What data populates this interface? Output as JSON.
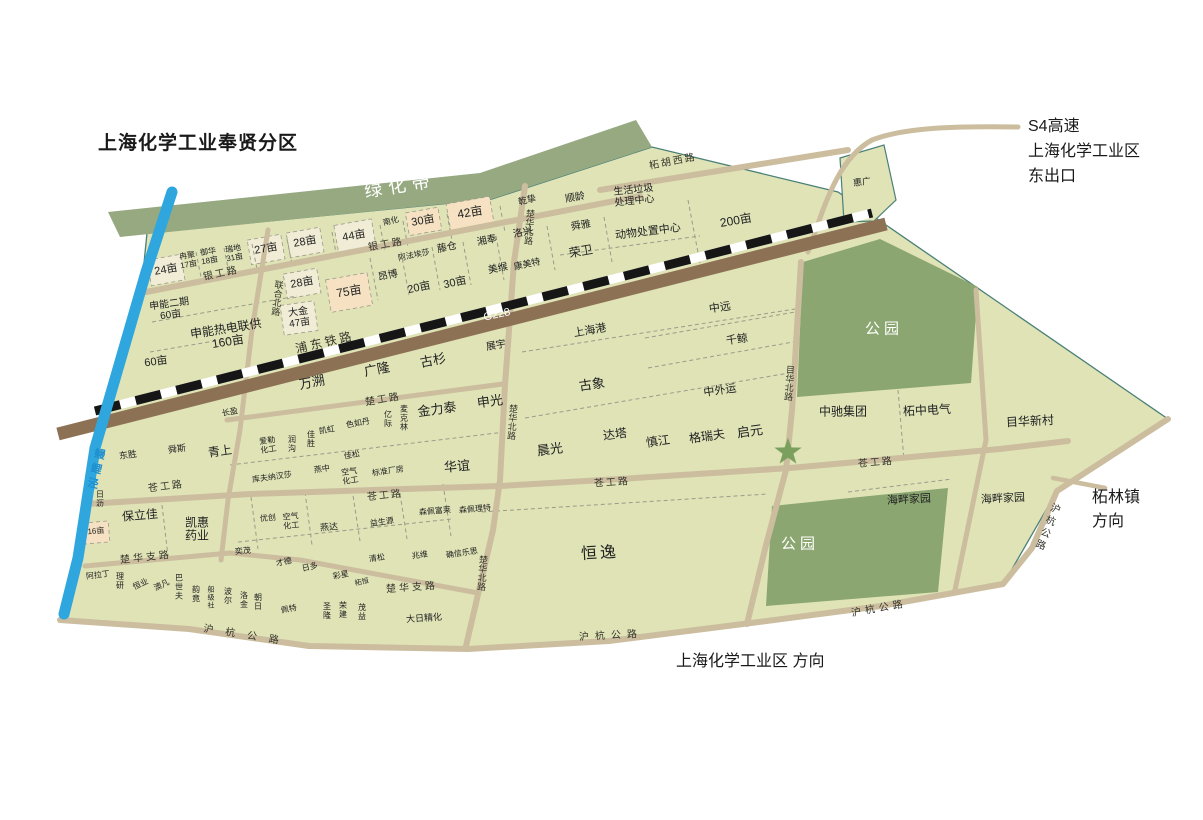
{
  "title": "上海化学工业奉贤分区",
  "annotations": {
    "s4_exit_text": "S4高速\n上海化学工业区\n东出口",
    "zhelin_text": "柘林镇\n方向",
    "direction_text": "上海化学工业区  方向"
  },
  "colors": {
    "map_body": "#dfe3b6",
    "green_band": "#97a981",
    "park": "#8ba671",
    "road": "#cbbd9e",
    "railway": "#8d7154",
    "river": "#2fa7de",
    "dashed_line": "#161616",
    "cream_parcel": "#f1ecd6",
    "peach_parcel": "#f6e2c2",
    "star": "#7ba05e",
    "boundary": "#4a8078",
    "river_label": "#1d8fd0"
  },
  "map_labels": [
    {
      "n": "green-belt-label",
      "t": "绿化带",
      "x": 400,
      "y": 186,
      "fs": 18,
      "r": -9,
      "ls": 6,
      "c": "wh"
    },
    {
      "n": "parcel-24mu",
      "t": "24亩",
      "x": 166,
      "y": 270,
      "fs": 11,
      "r": -10
    },
    {
      "n": "parcel-ranju-17mu",
      "t": "冉聚\n17亩",
      "x": 188,
      "y": 261,
      "fs": 8,
      "r": -10
    },
    {
      "n": "parcel-yuhua-18mu",
      "t": "御华\n18亩",
      "x": 209,
      "y": 257,
      "fs": 8,
      "r": -10
    },
    {
      "n": "parcel-ruidi-31mu",
      "t": "瑞地\n31亩",
      "x": 234,
      "y": 254,
      "fs": 8,
      "r": -10
    },
    {
      "n": "parcel-27mu",
      "t": "27亩",
      "x": 266,
      "y": 249,
      "fs": 11,
      "r": -10
    },
    {
      "n": "parcel-28mu-a",
      "t": "28亩",
      "x": 305,
      "y": 242,
      "fs": 11,
      "r": -10
    },
    {
      "n": "parcel-44mu",
      "t": "44亩",
      "x": 354,
      "y": 236,
      "fs": 11,
      "r": -10
    },
    {
      "n": "parcel-nanhua",
      "t": "南化",
      "x": 391,
      "y": 222,
      "fs": 8,
      "r": -14
    },
    {
      "n": "parcel-30mu-a",
      "t": "30亩",
      "x": 423,
      "y": 221,
      "fs": 11,
      "r": -10
    },
    {
      "n": "parcel-42mu",
      "t": "42亩",
      "x": 470,
      "y": 213,
      "fs": 12,
      "r": -10
    },
    {
      "n": "parcel-qianzhi",
      "t": "乾挚",
      "x": 527,
      "y": 200,
      "fs": 9,
      "r": -14
    },
    {
      "n": "parcel-shunling",
      "t": "顺龄",
      "x": 575,
      "y": 198,
      "fs": 10,
      "r": -10
    },
    {
      "n": "facility-waste-center",
      "t": "生活垃圾\n处理中心",
      "x": 634,
      "y": 196,
      "fs": 10,
      "r": -6
    },
    {
      "n": "road-zhehuxi",
      "t": "柘胡西路",
      "x": 673,
      "y": 162,
      "fs": 10,
      "r": -11,
      "ls": 2,
      "c": "road"
    },
    {
      "n": "parcel-huiguang",
      "t": "惠广",
      "x": 862,
      "y": 182,
      "fs": 9,
      "r": -8
    },
    {
      "n": "road-yingong-a",
      "t": "银工路",
      "x": 221,
      "y": 274,
      "fs": 10,
      "r": -12,
      "ls": 2,
      "c": "road"
    },
    {
      "n": "road-yingong-b",
      "t": "银工路",
      "x": 386,
      "y": 245,
      "fs": 10,
      "r": -10,
      "ls": 2,
      "c": "road"
    },
    {
      "n": "road-chuhuabei-n",
      "t": "楚华北路",
      "x": 529,
      "y": 227,
      "fs": 9,
      "r": 4,
      "c": "vt road"
    },
    {
      "n": "parcel-shunya",
      "t": "舜雅",
      "x": 581,
      "y": 226,
      "fs": 10,
      "r": -10
    },
    {
      "n": "parcel-luoxing",
      "t": "洛兴",
      "x": 523,
      "y": 233,
      "fs": 10,
      "r": -12
    },
    {
      "n": "parcel-xiangfeng",
      "t": "湘奉",
      "x": 487,
      "y": 241,
      "fs": 10,
      "r": -12
    },
    {
      "n": "parcel-tengcang",
      "t": "藤仓",
      "x": 447,
      "y": 248,
      "fs": 10,
      "r": -12
    },
    {
      "n": "parcel-afaaisha",
      "t": "阿法埃莎",
      "x": 414,
      "y": 256,
      "fs": 8,
      "r": -12
    },
    {
      "n": "parcel-angbo",
      "t": "昂博",
      "x": 388,
      "y": 276,
      "fs": 10,
      "r": -12
    },
    {
      "n": "parcel-meigou",
      "t": "美缑",
      "x": 498,
      "y": 269,
      "fs": 10,
      "r": -12
    },
    {
      "n": "parcel-kangmeite",
      "t": "康美特",
      "x": 527,
      "y": 264,
      "fs": 9,
      "r": -12
    },
    {
      "n": "parcel-rongwei",
      "t": "荣卫",
      "x": 581,
      "y": 252,
      "fs": 12,
      "r": -10
    },
    {
      "n": "facility-animal-center",
      "t": "动物处置中心",
      "x": 648,
      "y": 232,
      "fs": 11,
      "r": -7
    },
    {
      "n": "parcel-200mu",
      "t": "200亩",
      "x": 736,
      "y": 221,
      "fs": 12,
      "r": -10
    },
    {
      "n": "parcel-20mu",
      "t": "20亩",
      "x": 419,
      "y": 288,
      "fs": 11,
      "r": -12
    },
    {
      "n": "parcel-30mu-b",
      "t": "30亩",
      "x": 455,
      "y": 283,
      "fs": 11,
      "r": -12
    },
    {
      "n": "parcel-28mu-b",
      "t": "28亩",
      "x": 302,
      "y": 283,
      "fs": 11,
      "r": -10
    },
    {
      "n": "parcel-75mu",
      "t": "75亩",
      "x": 349,
      "y": 292,
      "fs": 12,
      "r": -10
    },
    {
      "n": "parcel-dajin-47mu",
      "t": "大金\n47亩",
      "x": 299,
      "y": 318,
      "fs": 10,
      "r": -8
    },
    {
      "n": "road-lianhebei",
      "t": "联合北路",
      "x": 277,
      "y": 298,
      "fs": 9,
      "r": 7,
      "c": "vt road"
    },
    {
      "n": "parcel-shenneng2-60mu",
      "t": "申能二期\n60亩",
      "x": 170,
      "y": 310,
      "fs": 10,
      "r": -8
    },
    {
      "n": "parcel-shenneng-160mu",
      "t": "申能热电联供\n160亩",
      "x": 227,
      "y": 336,
      "fs": 12,
      "r": -9
    },
    {
      "n": "parcel-60mu",
      "t": "60亩",
      "x": 156,
      "y": 362,
      "fs": 11,
      "r": -8
    },
    {
      "n": "railway-pudong-label",
      "t": "浦东铁路",
      "x": 325,
      "y": 343,
      "fs": 12,
      "r": -13,
      "ls": 3,
      "c": "road"
    },
    {
      "n": "route-g228-label",
      "t": "G228",
      "x": 497,
      "y": 315,
      "fs": 11,
      "r": -12,
      "c": "wh"
    },
    {
      "n": "parcel-wansu",
      "t": "万溯",
      "x": 312,
      "y": 383,
      "fs": 13,
      "r": -11
    },
    {
      "n": "parcel-guanglong",
      "t": "广隆",
      "x": 377,
      "y": 370,
      "fs": 13,
      "r": -11
    },
    {
      "n": "parcel-gushan",
      "t": "古杉",
      "x": 433,
      "y": 361,
      "fs": 13,
      "r": -11
    },
    {
      "n": "parcel-zhanyu",
      "t": "展宇",
      "x": 496,
      "y": 346,
      "fs": 10,
      "r": -10
    },
    {
      "n": "road-chugong",
      "t": "楚工路",
      "x": 383,
      "y": 400,
      "fs": 10,
      "r": -10,
      "ls": 2,
      "c": "road"
    },
    {
      "n": "parcel-serudan",
      "t": "色如丹",
      "x": 358,
      "y": 424,
      "fs": 8,
      "r": -10
    },
    {
      "n": "parcel-yiji",
      "t": "亿\n际",
      "x": 388,
      "y": 420,
      "fs": 8
    },
    {
      "n": "parcel-maikelin",
      "t": "麦\n克\n林",
      "x": 404,
      "y": 419,
      "fs": 8
    },
    {
      "n": "parcel-jinlitai",
      "t": "金力泰",
      "x": 437,
      "y": 410,
      "fs": 13,
      "r": -8
    },
    {
      "n": "parcel-shenguang",
      "t": "申光",
      "x": 490,
      "y": 402,
      "fs": 13,
      "r": -8
    },
    {
      "n": "road-chuhuabei-m",
      "t": "楚华北路",
      "x": 512,
      "y": 422,
      "fs": 9,
      "r": 4,
      "c": "vt road"
    },
    {
      "n": "parcel-guxiang",
      "t": "古象",
      "x": 592,
      "y": 385,
      "fs": 13,
      "r": -8
    },
    {
      "n": "parcel-shanghaigang",
      "t": "上海港",
      "x": 590,
      "y": 331,
      "fs": 11,
      "r": -10
    },
    {
      "n": "parcel-zhongyuan",
      "t": "中远",
      "x": 720,
      "y": 308,
      "fs": 11,
      "r": -8
    },
    {
      "n": "parcel-qianjing",
      "t": "千鲸",
      "x": 737,
      "y": 340,
      "fs": 11,
      "r": -8
    },
    {
      "n": "parcel-zhongwaiyun",
      "t": "中外运",
      "x": 720,
      "y": 391,
      "fs": 11,
      "r": -8
    },
    {
      "n": "road-muhuabei-n",
      "t": "目华北路",
      "x": 789,
      "y": 383,
      "fs": 9,
      "r": 4,
      "c": "vt road"
    },
    {
      "n": "parcel-chenguang",
      "t": "晨光",
      "x": 550,
      "y": 450,
      "fs": 13,
      "r": -8
    },
    {
      "n": "parcel-data",
      "t": "达塔",
      "x": 615,
      "y": 435,
      "fs": 12,
      "r": -8
    },
    {
      "n": "parcel-shenjiang",
      "t": "慎江",
      "x": 658,
      "y": 442,
      "fs": 12,
      "r": -8
    },
    {
      "n": "parcel-geruifu",
      "t": "格瑞夫",
      "x": 707,
      "y": 437,
      "fs": 12,
      "r": -8
    },
    {
      "n": "parcel-qiyuan",
      "t": "启元",
      "x": 750,
      "y": 432,
      "fs": 13,
      "r": -8
    },
    {
      "n": "parcel-zhongchi",
      "t": "中驰集团",
      "x": 843,
      "y": 412,
      "fs": 12
    },
    {
      "n": "parcel-zhezhong",
      "t": "柘中电气",
      "x": 927,
      "y": 411,
      "fs": 12,
      "r": -3
    },
    {
      "n": "parcel-muhuaxincun",
      "t": "目华新村",
      "x": 1030,
      "y": 422,
      "fs": 12,
      "r": -3
    },
    {
      "n": "park-label-1",
      "t": "公园",
      "x": 884,
      "y": 330,
      "fs": 15,
      "ls": 4,
      "c": "wh"
    },
    {
      "n": "park-label-2",
      "t": "公园",
      "x": 800,
      "y": 545,
      "fs": 15,
      "ls": 4,
      "c": "wh"
    },
    {
      "n": "parcel-haipan-1",
      "t": "海畔家园",
      "x": 909,
      "y": 500,
      "fs": 11,
      "r": -3
    },
    {
      "n": "parcel-haipan-2",
      "t": "海畔家园",
      "x": 1003,
      "y": 499,
      "fs": 11,
      "r": -3
    },
    {
      "n": "road-canggong-1",
      "t": "苍工路",
      "x": 166,
      "y": 487,
      "fs": 10,
      "r": -7,
      "ls": 2,
      "c": "road"
    },
    {
      "n": "road-canggong-2",
      "t": "苍工路",
      "x": 385,
      "y": 496,
      "fs": 10,
      "r": -6,
      "ls": 2,
      "c": "road"
    },
    {
      "n": "road-canggong-3",
      "t": "苍工路",
      "x": 612,
      "y": 483,
      "fs": 10,
      "r": -4,
      "ls": 2,
      "c": "road"
    },
    {
      "n": "road-canggong-4",
      "t": "苍工路",
      "x": 876,
      "y": 463,
      "fs": 10,
      "r": -5,
      "ls": 2,
      "c": "road"
    },
    {
      "n": "parcel-huayi",
      "t": "华谊",
      "x": 457,
      "y": 467,
      "fs": 13,
      "r": -5
    },
    {
      "n": "parcel-biaozhun",
      "t": "标准厂房",
      "x": 388,
      "y": 472,
      "fs": 8,
      "r": -8
    },
    {
      "n": "parcel-kongqi-1",
      "t": "空气\n化工",
      "x": 350,
      "y": 477,
      "fs": 8,
      "r": -8
    },
    {
      "n": "parcel-yanzhong",
      "t": "燕中",
      "x": 322,
      "y": 470,
      "fs": 8,
      "r": -8
    },
    {
      "n": "parcel-kufuna",
      "t": "库夫纳汉莎",
      "x": 272,
      "y": 478,
      "fs": 8,
      "r": -8
    },
    {
      "n": "parcel-jiasong",
      "t": "佳松",
      "x": 352,
      "y": 456,
      "fs": 8,
      "r": -10
    },
    {
      "n": "parcel-kaihong",
      "t": "凯虹",
      "x": 327,
      "y": 431,
      "fs": 8,
      "r": -10
    },
    {
      "n": "parcel-jiasheng",
      "t": "佳\n胜",
      "x": 311,
      "y": 440,
      "fs": 8
    },
    {
      "n": "parcel-rungou",
      "t": "润\n沟",
      "x": 292,
      "y": 445,
      "fs": 8
    },
    {
      "n": "parcel-ailehuagong",
      "t": "爱勒\n化工",
      "x": 268,
      "y": 446,
      "fs": 8,
      "r": -8
    },
    {
      "n": "parcel-qingshang",
      "t": "青上",
      "x": 220,
      "y": 452,
      "fs": 12,
      "r": -8
    },
    {
      "n": "parcel-shunsi",
      "t": "舜斯",
      "x": 177,
      "y": 449,
      "fs": 9,
      "r": -8
    },
    {
      "n": "parcel-dongsheng",
      "t": "东胜",
      "x": 128,
      "y": 455,
      "fs": 9,
      "r": -8
    },
    {
      "n": "parcel-changying",
      "t": "长盈",
      "x": 230,
      "y": 413,
      "fs": 8,
      "r": -10
    },
    {
      "n": "river-manliji-label",
      "t": "鳗鲤泾",
      "x": 95,
      "y": 470,
      "fs": 11,
      "r": 13,
      "ls": 4,
      "c": "vt riv"
    },
    {
      "n": "parcel-rili",
      "t": "日\n沥",
      "x": 100,
      "y": 500,
      "fs": 8
    },
    {
      "n": "parcel-baolijia",
      "t": "保立佳",
      "x": 140,
      "y": 516,
      "fs": 12,
      "r": -5
    },
    {
      "n": "parcel-kaihui",
      "t": "凯惠\n药业",
      "x": 197,
      "y": 530,
      "fs": 12
    },
    {
      "n": "parcel-16mu",
      "t": "16亩",
      "x": 96,
      "y": 532,
      "fs": 8,
      "r": -5
    },
    {
      "n": "parcel-youchuang",
      "t": "优创",
      "x": 268,
      "y": 519,
      "fs": 8,
      "r": -5
    },
    {
      "n": "parcel-kongqi-2",
      "t": "空气\n化工",
      "x": 291,
      "y": 522,
      "fs": 8,
      "r": -5
    },
    {
      "n": "parcel-yanda",
      "t": "燕达",
      "x": 329,
      "y": 527,
      "fs": 9,
      "r": -5
    },
    {
      "n": "parcel-yimao",
      "t": "奕茂",
      "x": 243,
      "y": 552,
      "fs": 8,
      "r": -5
    },
    {
      "n": "parcel-caide",
      "t": "才德",
      "x": 284,
      "y": 563,
      "fs": 8,
      "r": -12
    },
    {
      "n": "parcel-riduo",
      "t": "日多",
      "x": 310,
      "y": 568,
      "fs": 8,
      "r": -12
    },
    {
      "n": "parcel-caixing",
      "t": "彩星",
      "x": 341,
      "y": 576,
      "fs": 8,
      "r": -12
    },
    {
      "n": "parcel-zheheng",
      "t": "柘恒",
      "x": 362,
      "y": 583,
      "fs": 7,
      "r": -12
    },
    {
      "n": "parcel-qingsong",
      "t": "清松",
      "x": 377,
      "y": 559,
      "fs": 8,
      "r": -8
    },
    {
      "n": "parcel-zhaowei",
      "t": "兆维",
      "x": 420,
      "y": 556,
      "fs": 8,
      "r": -8
    },
    {
      "n": "parcel-yishengyuan",
      "t": "益生源",
      "x": 382,
      "y": 523,
      "fs": 8,
      "r": -8
    },
    {
      "n": "parcel-senpeifulai",
      "t": "森佩富莱",
      "x": 435,
      "y": 512,
      "fs": 8,
      "r": -5
    },
    {
      "n": "parcel-senpeilite",
      "t": "森佩理特",
      "x": 475,
      "y": 510,
      "fs": 8,
      "r": -5
    },
    {
      "n": "parcel-quexinlesi",
      "t": "确信乐思",
      "x": 462,
      "y": 554,
      "fs": 8,
      "r": -8
    },
    {
      "n": "road-chuhuabei-s",
      "t": "楚华北路",
      "x": 482,
      "y": 573,
      "fs": 9,
      "r": 4,
      "c": "vt road"
    },
    {
      "n": "road-chuhuazhi-1",
      "t": "楚华支路",
      "x": 146,
      "y": 558,
      "fs": 10,
      "r": -6,
      "ls": 3,
      "c": "road"
    },
    {
      "n": "road-chuhuazhi-2",
      "t": "楚华支路",
      "x": 412,
      "y": 588,
      "fs": 10,
      "r": -4,
      "ls": 3,
      "c": "road"
    },
    {
      "n": "parcel-darijinghua",
      "t": "大日精化",
      "x": 424,
      "y": 618,
      "fs": 9,
      "r": -4
    },
    {
      "n": "parcel-hengyi",
      "t": "恒逸",
      "x": 600,
      "y": 554,
      "fs": 16,
      "ls": 3,
      "r": -3
    },
    {
      "n": "parcel-aladin",
      "t": "阿拉丁",
      "x": 98,
      "y": 576,
      "fs": 8,
      "r": -8
    },
    {
      "n": "parcel-liyan",
      "t": "理\n研",
      "x": 120,
      "y": 582,
      "fs": 8
    },
    {
      "n": "parcel-hengye",
      "t": "恒业",
      "x": 141,
      "y": 585,
      "fs": 8,
      "r": -25
    },
    {
      "n": "parcel-aofan",
      "t": "澳凡",
      "x": 162,
      "y": 586,
      "fs": 8,
      "r": -25
    },
    {
      "n": "parcel-bashifu",
      "t": "巴\n世\n夫",
      "x": 179,
      "y": 588,
      "fs": 8
    },
    {
      "n": "parcel-yunjing",
      "t": "韵\n竟",
      "x": 196,
      "y": 595,
      "fs": 8
    },
    {
      "n": "parcel-chuanjishe",
      "t": "船\n级\n社",
      "x": 211,
      "y": 598,
      "fs": 7
    },
    {
      "n": "parcel-boer",
      "t": "波\n尔",
      "x": 228,
      "y": 597,
      "fs": 8
    },
    {
      "n": "parcel-luojin",
      "t": "洛\n金",
      "x": 244,
      "y": 601,
      "fs": 8
    },
    {
      "n": "parcel-zhaori",
      "t": "朝\n日",
      "x": 258,
      "y": 603,
      "fs": 8
    },
    {
      "n": "parcel-peite",
      "t": "佩特",
      "x": 289,
      "y": 610,
      "fs": 8,
      "r": -10
    },
    {
      "n": "parcel-shenglong",
      "t": "圣\n隆",
      "x": 327,
      "y": 612,
      "fs": 8
    },
    {
      "n": "parcel-rongjian",
      "t": "荣\n建",
      "x": 343,
      "y": 611,
      "fs": 8
    },
    {
      "n": "parcel-maoyi",
      "t": "茂\n益",
      "x": 362,
      "y": 613,
      "fs": 8
    },
    {
      "n": "road-huhang-1",
      "t": "沪杭公路",
      "x": 247,
      "y": 636,
      "fs": 10,
      "r": 9,
      "ls": 12,
      "c": "road"
    },
    {
      "n": "road-huhang-2",
      "t": "沪杭公路",
      "x": 611,
      "y": 636,
      "fs": 10,
      "r": -3,
      "ls": 6,
      "c": "road"
    },
    {
      "n": "road-huhang-3",
      "t": "沪杭公路",
      "x": 879,
      "y": 609,
      "fs": 10,
      "r": -10,
      "ls": 4,
      "c": "road"
    },
    {
      "n": "road-huhang-4",
      "t": "沪杭公路",
      "x": 1046,
      "y": 527,
      "fs": 10,
      "r": 22,
      "ls": 3,
      "c": "vt road"
    }
  ]
}
